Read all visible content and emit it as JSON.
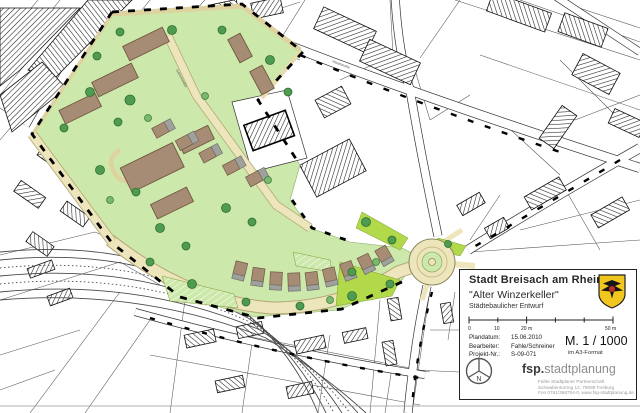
{
  "map": {
    "street_labels": [
      "Gartenstraße",
      "Hauptstraße"
    ],
    "colors": {
      "site_green": "#cde8ab",
      "lime_green": "#b2d94a",
      "road_beige": "#ede5bb",
      "road_edge": "#b3a775",
      "building_brown": "#a68c74",
      "roof_gray": "#a0a09d",
      "tree_green": "#4f9b4f",
      "cadastral_line": "#444444"
    }
  },
  "title_block": {
    "city": "Stadt Breisach am Rhein",
    "project_title": "\"Alter Winzerkeller\"",
    "plan_type": "Städtebaulicher Entwurf",
    "scale_ticks": [
      "0",
      "10",
      "20 m",
      "50 m"
    ],
    "meta": [
      {
        "label": "Plandatum:",
        "value": "15.06.2010"
      },
      {
        "label": "Bearbeiter:",
        "value": "Fahle/Schreiner"
      },
      {
        "label": "Projekt-Nr.:",
        "value": "S-09-071"
      }
    ],
    "scale_text": "M.  1 / 1000",
    "scale_note": "im A3-Format",
    "logo_bold": "fsp.",
    "logo_rest": "stadtplanung",
    "firm_lines": [
      "Fahle Stadtplaner Partnerschaft",
      "Schwabentorring 12, 79098 Freiburg",
      "Fon 0761/368754-0, www.fsp-stadtplanung.de"
    ],
    "north_letter": "N"
  }
}
